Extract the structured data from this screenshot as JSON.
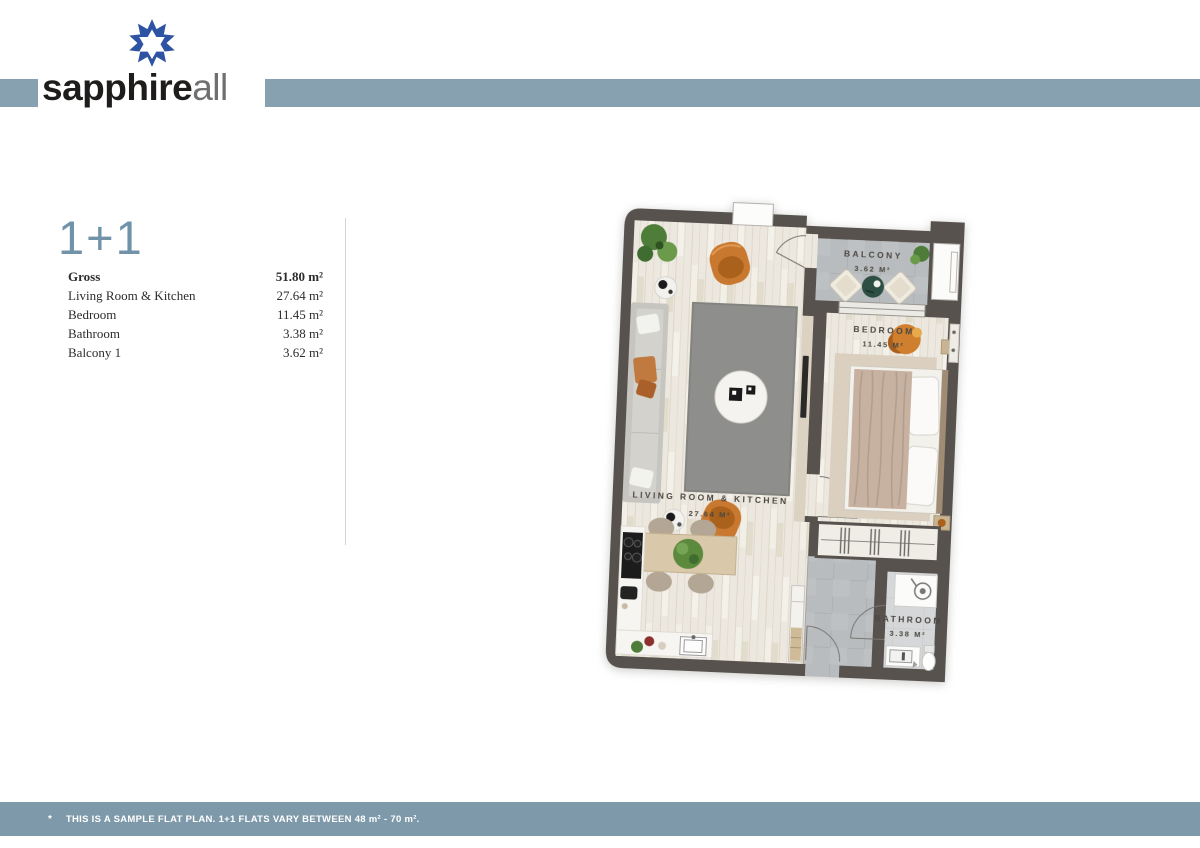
{
  "brand": {
    "name_bold": "sapphire",
    "name_light": "all"
  },
  "unit": {
    "type_label": "1+1",
    "areas": [
      {
        "label": "Gross",
        "value": "51.80 m²"
      },
      {
        "label": "Living Room & Kitchen",
        "value": "27.64 m²"
      },
      {
        "label": "Bedroom",
        "value": "11.45 m²"
      },
      {
        "label": "Bathroom",
        "value": "3.38 m²"
      },
      {
        "label": "Balcony 1",
        "value": "3.62 m²"
      }
    ]
  },
  "floorplan": {
    "rooms": {
      "balcony": {
        "name": "BALCONY",
        "area": "3.62 M²"
      },
      "bedroom": {
        "name": "BEDROOM",
        "area": "11.45 M²"
      },
      "living": {
        "name": "LIVING ROOM & KITCHEN",
        "area": "27.64 M²"
      },
      "bathroom": {
        "name": "BATHROOM",
        "area": "3.38 M²"
      }
    }
  },
  "footer": {
    "marker": "*",
    "note": "THIS IS A SAMPLE FLAT PLAN. 1+1 FLATS VARY BETWEEN 48 m² - 70 m²."
  },
  "colors": {
    "header_band": "#87a1b1",
    "footer_band": "#7e99aa",
    "logo_blue": "#2e53a3",
    "heading_blue": "#7093aa",
    "wall": "#57524d",
    "wood_floor": "#ece8df",
    "tile_gray": "#b9bcbe",
    "accent_orange": "#c9782f"
  }
}
